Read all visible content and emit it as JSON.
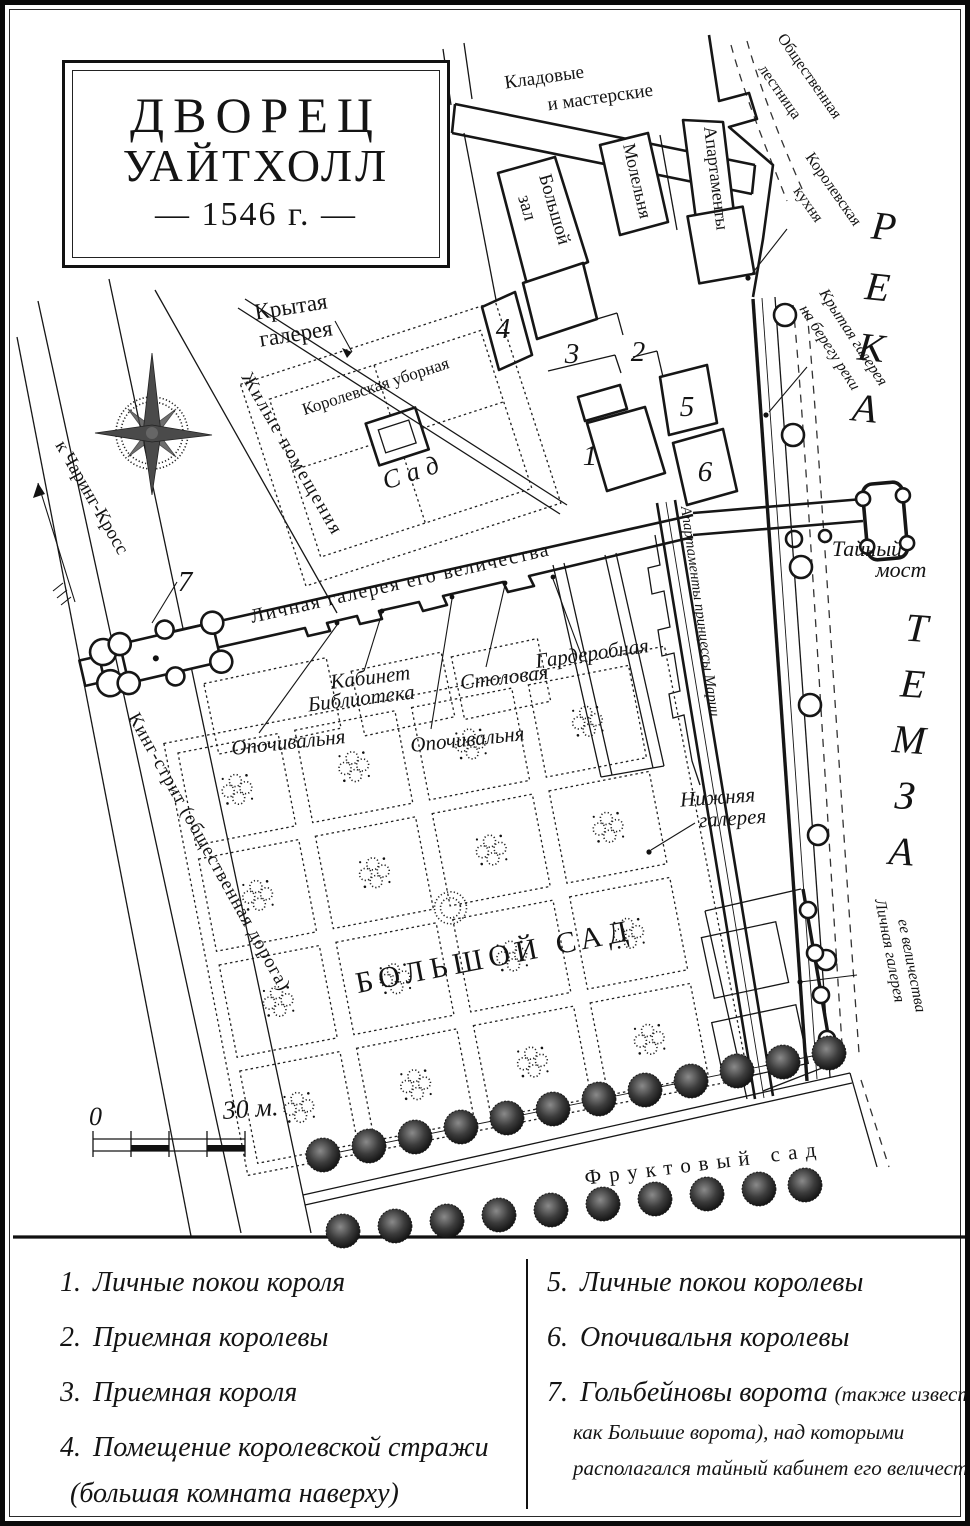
{
  "title": {
    "l1": "ДВОРЕЦ",
    "l2": "УАЙТХОЛЛ",
    "l3": "— 1546 г. —"
  },
  "map": {
    "storerooms_l1": "Кладовые",
    "storerooms_l2": "и мастерские",
    "public_stairs_l1": "Общественная",
    "public_stairs_l2": "лестница",
    "great_hall_l1": "Большой",
    "great_hall_l2": "зал",
    "chapel": "Молельня",
    "apartments": "Апартаменты",
    "kitchen_l1": "Королевская",
    "kitchen_l2": "кухня",
    "river_word_1": "РЕКА",
    "river_word_2": "ТЕМЗА",
    "river_gallery_l1": "Крытая галерея",
    "river_gallery_l2": "на берегу реки",
    "covered_gallery_l1": "Крытая",
    "covered_gallery_l2": "галерея",
    "royal_closet": "Королевская уборная",
    "small_garden": "Сад",
    "lodgings": "Жилые помещения",
    "charing": "к Чаринг-Кросс",
    "privy_gallery": "Личная галерея его величества",
    "secret_bridge_l1": "Тайный",
    "secret_bridge_l2": "мост",
    "princess_mary": "Апартаменты принцессы Марии",
    "wardrobe": "Гардеробная",
    "cabinet": "Кабинет",
    "library": "Библиотека",
    "dining": "Столовая",
    "bedchamber_a": "Опочивальня",
    "bedchamber_b": "Опочивальня",
    "lower_gallery_l1": "Нижняя",
    "lower_gallery_l2": "галерея",
    "king_street": "Кинг-стрит (общественная дорога)",
    "great_garden": "БОЛЬШОЙ САД",
    "queens_gallery_l1": "Личная галерея",
    "queens_gallery_l2": "ее величества",
    "orchard": "Фруктовый сад",
    "scale_zero": "0",
    "scale_thirty": "30 м.",
    "n1": "1",
    "n2": "2",
    "n3": "3",
    "n4": "4",
    "n5": "5",
    "n6": "6",
    "n7": "7"
  },
  "legend": {
    "left": [
      {
        "num": "1.",
        "text": "Личные покои короля"
      },
      {
        "num": "2.",
        "text": "Приемная королевы"
      },
      {
        "num": "3.",
        "text": "Приемная короля"
      },
      {
        "num": "4.",
        "text": "Помещение королевской стражи",
        "note": "(большая комната наверху)"
      }
    ],
    "right": [
      {
        "num": "5.",
        "text": "Личные покои королевы"
      },
      {
        "num": "6.",
        "text": "Опочивальня королевы"
      },
      {
        "num": "7.",
        "text": "Гольбейновы ворота",
        "suffix": "(также известные",
        "note2": "как Большие ворота), над которыми",
        "note3": "располагался тайный кабинет его величества"
      }
    ]
  },
  "colors": {
    "ink": "#141414",
    "paper": "#ffffff"
  }
}
